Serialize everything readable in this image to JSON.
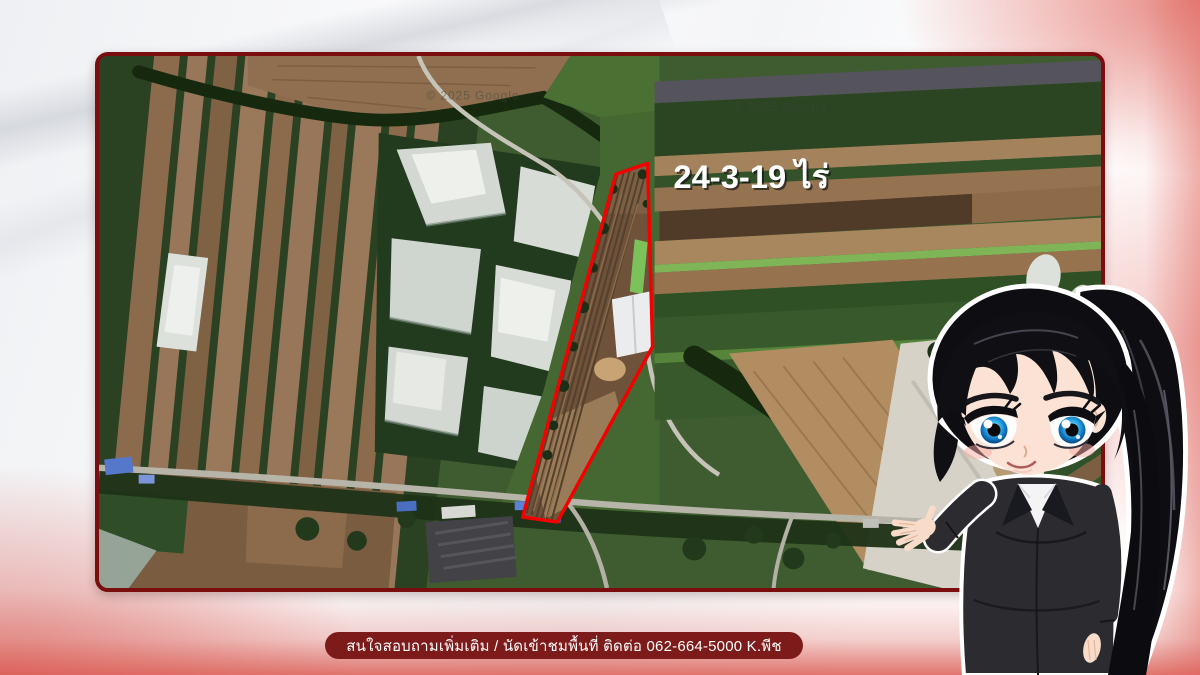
{
  "map": {
    "area_label": "24-3-19 ไร่",
    "watermark": "© 2025 Google",
    "outline_color": "#ff0000",
    "frame_color": "#7a0d0d"
  },
  "footer": {
    "contact_text": "สนใจสอบถามเพิ่มเติม / นัดเข้าชมพื้นที่ ติดต่อ 062-664-5000 K.พีช",
    "bar_color": "#7d1a1a",
    "text_color": "#ffffff"
  },
  "theme": {
    "accent_pink": "#e06860",
    "background": "#f4f5f7"
  }
}
